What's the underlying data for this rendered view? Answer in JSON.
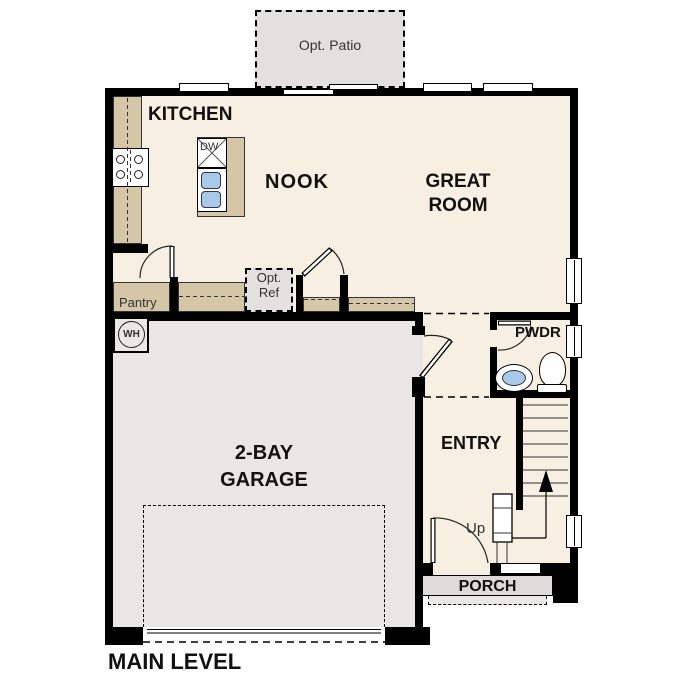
{
  "title": "MAIN LEVEL",
  "labels": {
    "opt_patio": "Opt. Patio",
    "kitchen": "KITCHEN",
    "nook": "NOOK",
    "great_room": "GREAT\nROOM",
    "pantry": "Pantry",
    "opt_ref": "Opt.\nRef",
    "dw": "DW",
    "wh": "WH",
    "garage": "2-BAY\nGARAGE",
    "pwdr": "PWDR",
    "entry": "ENTRY",
    "up": "Up",
    "porch": "PORCH",
    "main_level": "MAIN LEVEL"
  },
  "colors": {
    "wall": "#000000",
    "floor": "#f7efe2",
    "counter": "#d5c6a7",
    "garage_floor": "#e8e7e5",
    "patio": "#e2e1df",
    "porch": "#dcdbd9",
    "porch_step": "#e9e8e6",
    "fixture_blue": "#a9c9e9"
  }
}
